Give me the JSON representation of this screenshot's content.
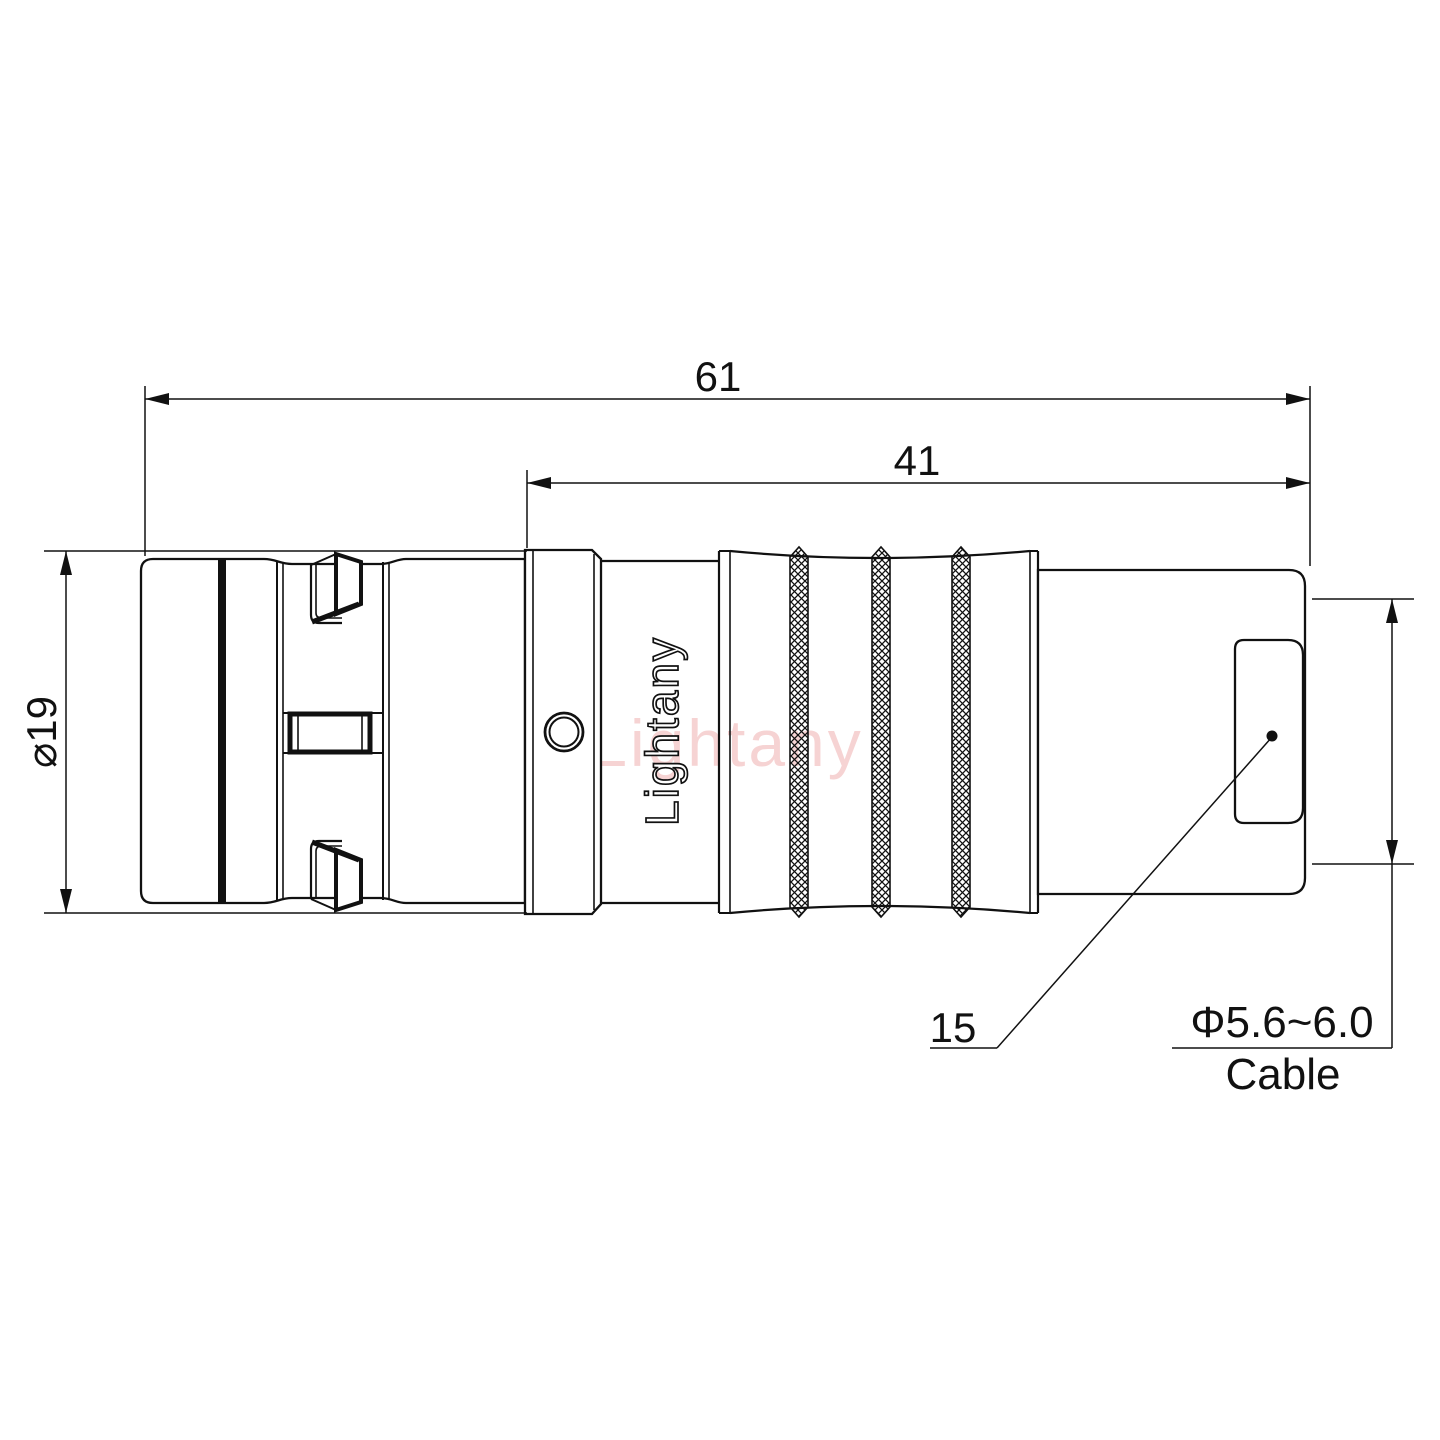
{
  "labels": {
    "overall_length": "61",
    "rear_section_length": "41",
    "outer_diameter": "⌀19",
    "strain_relief_ref": "15",
    "cable_diameter_range": "Φ5.6~6.0",
    "cable": "Cable"
  },
  "branding": {
    "engraving": "Lightany",
    "watermark": "Lightany"
  },
  "colors": {
    "line": "#111111",
    "watermark": "#efb0b0",
    "background": "#ffffff"
  }
}
